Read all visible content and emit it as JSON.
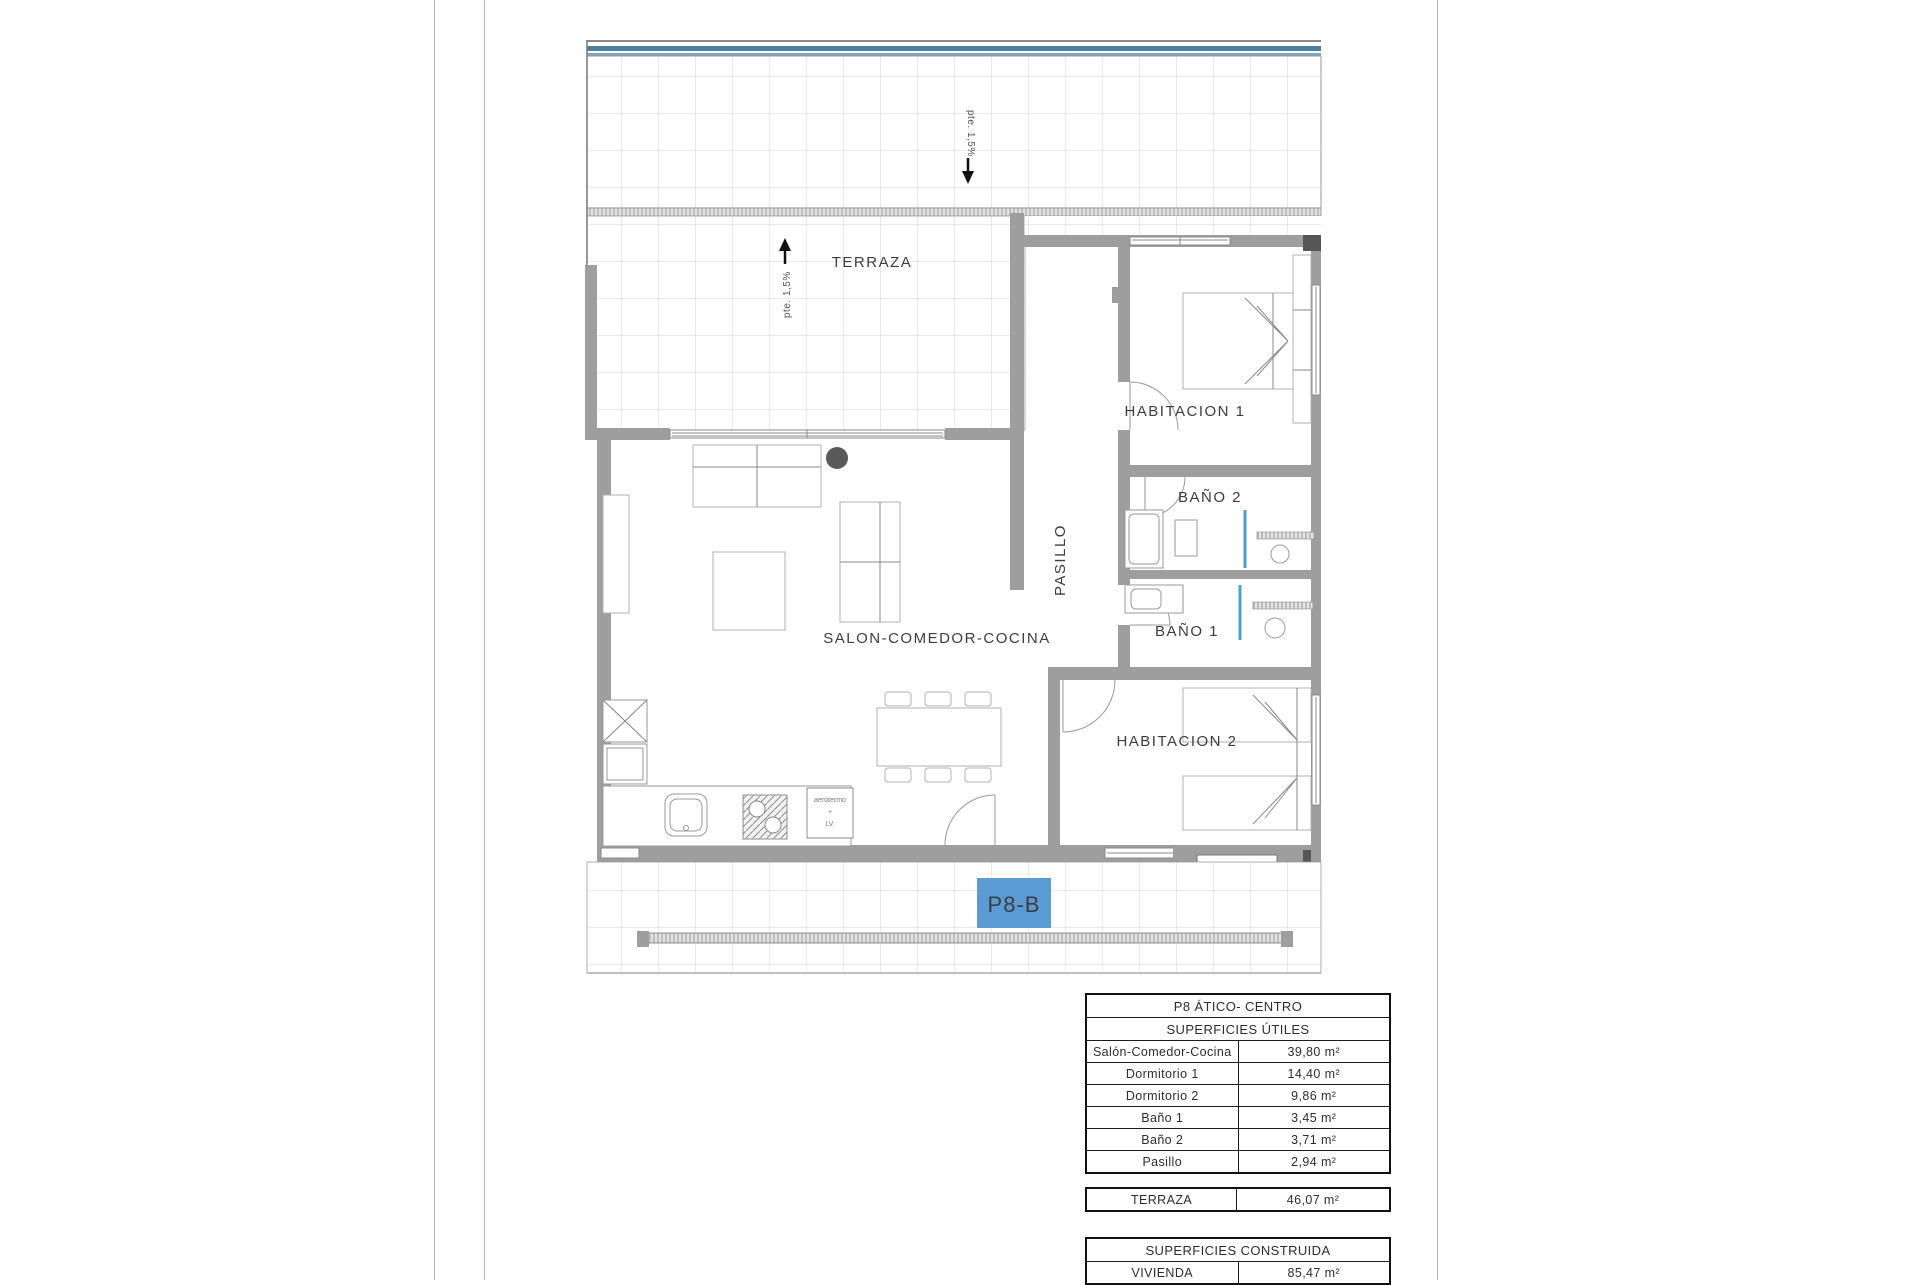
{
  "plan": {
    "unit_label": "P8-B",
    "terraza_label": "TERRAZA",
    "slope_top": "pte. 1,5%",
    "slope_mid": "pte. 1,5%",
    "salon_label": "SALON-COMEDOR-COCINA",
    "pasillo_label": "PASILLO",
    "habitacion1_label": "HABITACION 1",
    "habitacion2_label": "HABITACION 2",
    "bano1_label": "BAÑO 1",
    "bano2_label": "BAÑO 2",
    "appliance_line1": "aerotermo",
    "appliance_line2": "+",
    "appliance_line3": "LV."
  },
  "tables": {
    "utiles": {
      "title": "P8 ÁTICO- CENTRO",
      "subtitle": "SUPERFICIES ÚTILES",
      "rows": [
        {
          "label": "Salón-Comedor-Cocina",
          "value": "39,80 m²"
        },
        {
          "label": "Dormitorio 1",
          "value": "14,40 m²"
        },
        {
          "label": "Dormitorio 2",
          "value": "9,86 m²"
        },
        {
          "label": "Baño 1",
          "value": "3,45 m²"
        },
        {
          "label": "Baño 2",
          "value": "3,71 m²"
        },
        {
          "label": "Pasillo",
          "value": "2,94 m²"
        }
      ]
    },
    "terraza_row": {
      "label": "TERRAZA",
      "value": "46,07 m²"
    },
    "construida": {
      "title": "SUPERFICIES CONSTRUIDA",
      "rows": [
        {
          "label": "VIVIENDA",
          "value": "85,47 m²"
        }
      ]
    }
  },
  "colors": {
    "unit_badge_blue": "#5b9bd5",
    "roof_edge_blue": "#4d7f9e",
    "wall_gray": "#9e9e9e",
    "shower_screen_blue": "#4ba0c9"
  }
}
